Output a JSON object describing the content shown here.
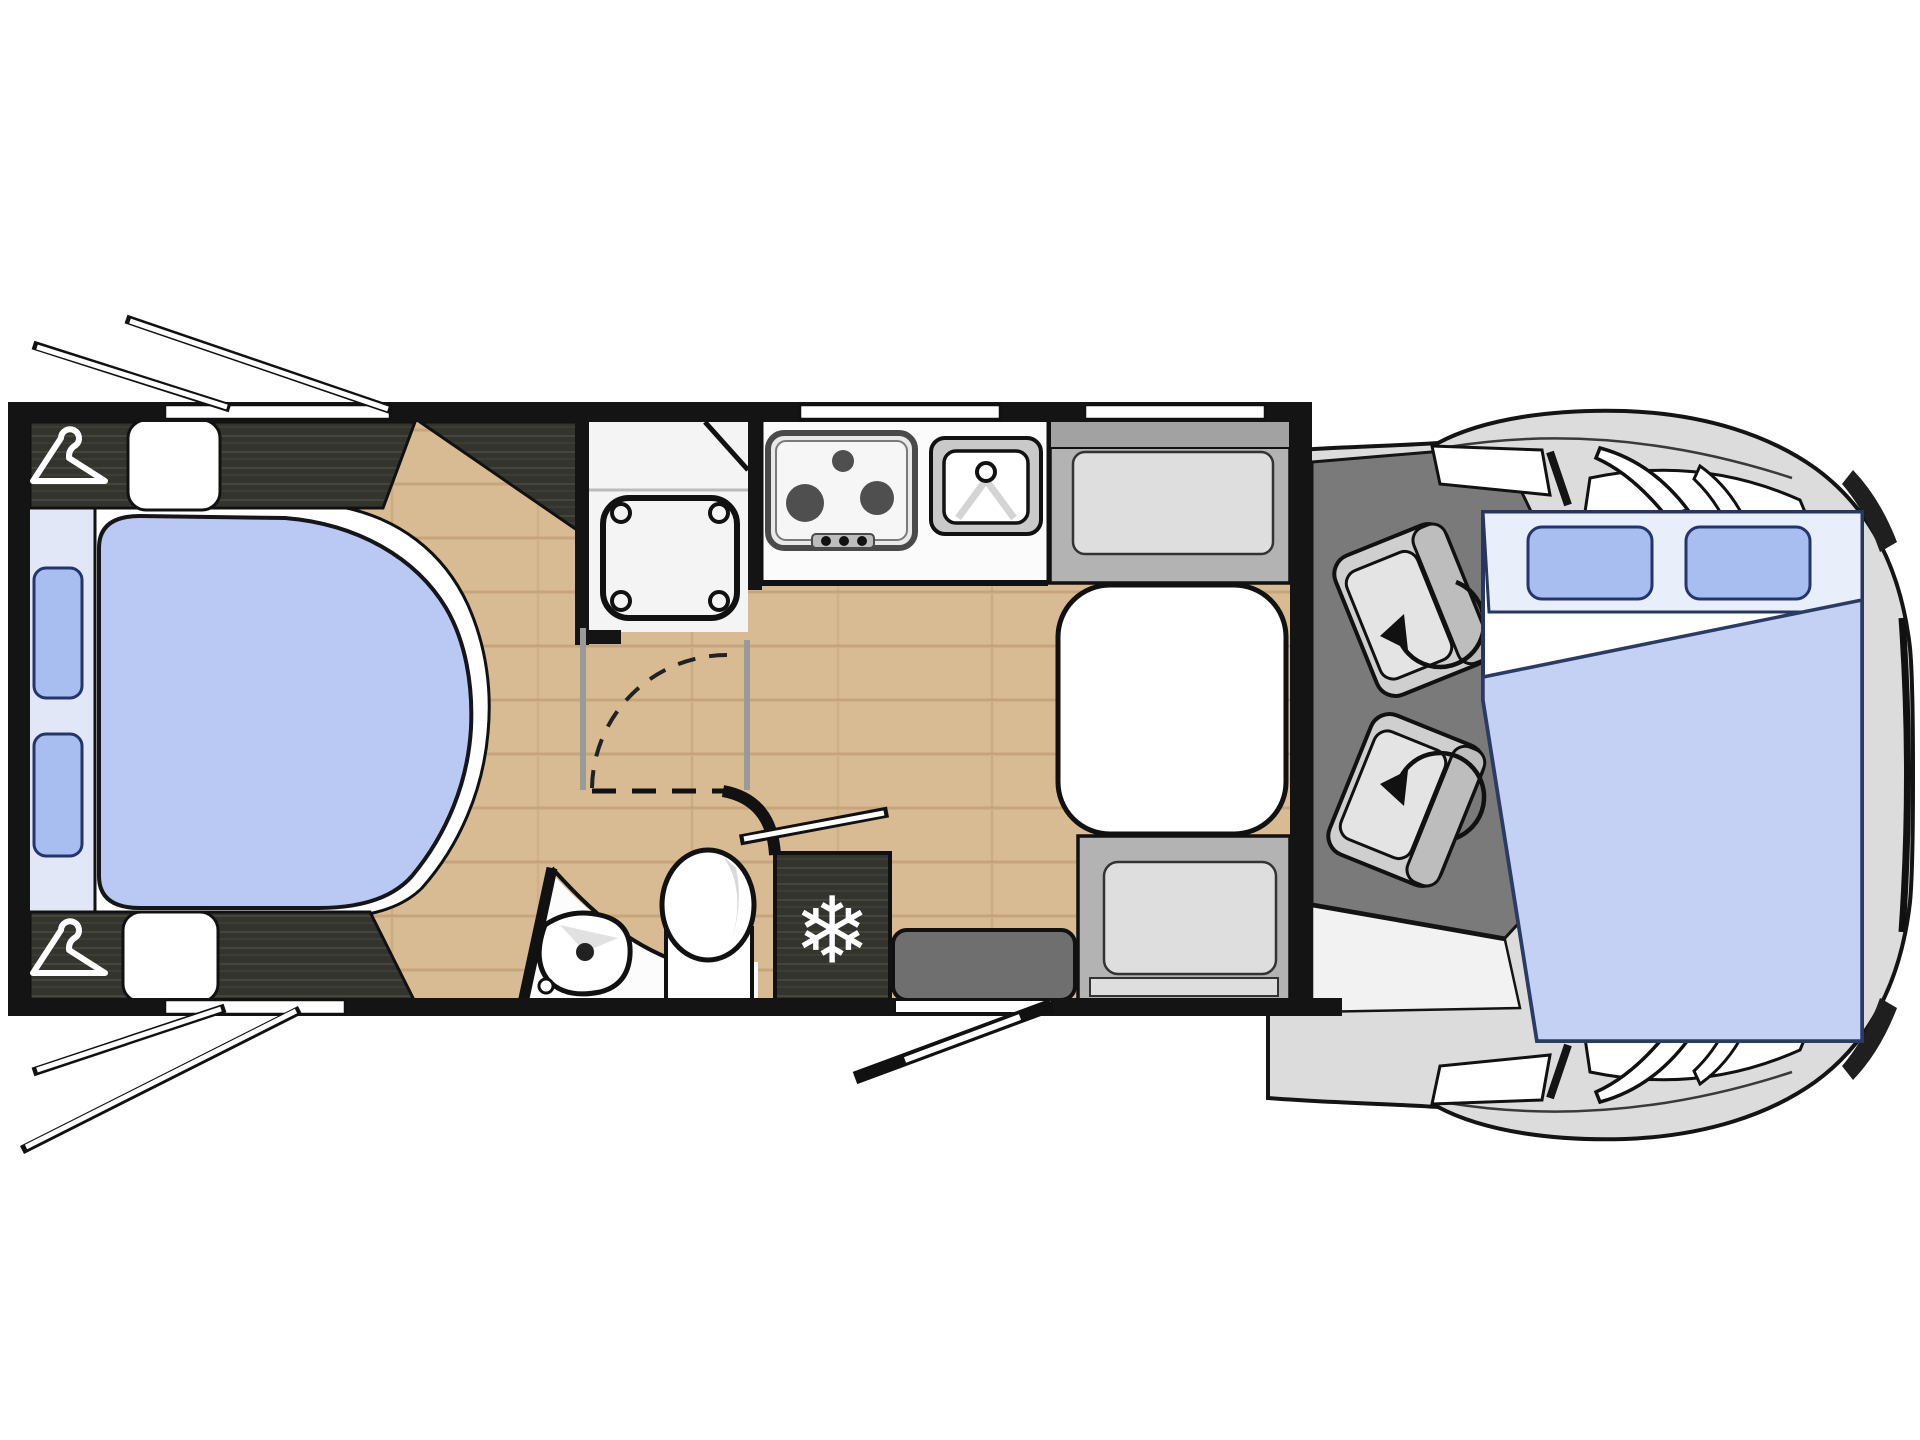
{
  "title": "motorhome-floorplan",
  "palette": {
    "wall": "#141414",
    "outline": "#111111",
    "wood": "#d8bb92",
    "wood_line": "#b8946a",
    "dark_wood": "#34342e",
    "dark_wood_line": "#5c5c50",
    "bed_white": "#ffffff",
    "headboard": "#e2e7f8",
    "duvet": "#b9c9f3",
    "pillow": "#a9bef0",
    "pillow_stroke": "#24356b",
    "bath_white": "#fcfcfc",
    "shower_floor": "#f4f4f4",
    "counter_white": "#fbfbfb",
    "hob_rim": "#e9e9e9",
    "burner": "#4f4f4f",
    "sink_rim": "#c9c9c9",
    "bench_outer": "#b3b3b3",
    "bench_back": "#a2a2a2",
    "bench_cushion": "#dedede",
    "table_white": "#ffffff",
    "step_grey": "#6f6f6f",
    "cab_body": "#dcdcdc",
    "cab_floor": "#7a7a7a",
    "seat_grey": "#cfcfcf",
    "seat_back": "#bdbdbd",
    "seat_cushion": "#e4e4e4",
    "dropbed_head": "#e9eefb",
    "dropbed_duvet": "#c4d1f4",
    "silver": "#9a9a9a",
    "glass_white": "#ffffff",
    "headlight_dark": "#1f1f1f"
  },
  "icons": {
    "snowflake": "❄",
    "hanger": "coat-hanger",
    "swivel": "rotation-arrow"
  },
  "plan": {
    "vehicle_type": "motorhome-low-profile",
    "orientation": "cab-at-right",
    "rooms": [
      "rear-bedroom",
      "washroom",
      "kitchen",
      "dinette",
      "cab"
    ],
    "features": [
      {
        "name": "wardrobe",
        "icon": "coat-hanger",
        "count": 2
      },
      {
        "name": "island-bed",
        "bedding": "blue-duvet",
        "pillows": 2,
        "cushions": 2
      },
      {
        "name": "shower-cubicle",
        "tray": "square"
      },
      {
        "name": "washbasin",
        "tap": 1
      },
      {
        "name": "toilet"
      },
      {
        "name": "hob",
        "burners": 3,
        "knobs": 3
      },
      {
        "name": "kitchen-sink",
        "tap": 1
      },
      {
        "name": "fridge",
        "icon": "snowflake"
      },
      {
        "name": "dinette-table"
      },
      {
        "name": "bench-seat",
        "count": 2
      },
      {
        "name": "entry-step"
      },
      {
        "name": "entry-door",
        "state": "open"
      },
      {
        "name": "cab-swivel-seat",
        "count": 2,
        "icon": "rotation-arrow"
      },
      {
        "name": "drop-down-bed",
        "pillows": 2,
        "bedding": "blue-duvet"
      },
      {
        "name": "opening-window",
        "count": 4,
        "state": "open"
      }
    ]
  }
}
